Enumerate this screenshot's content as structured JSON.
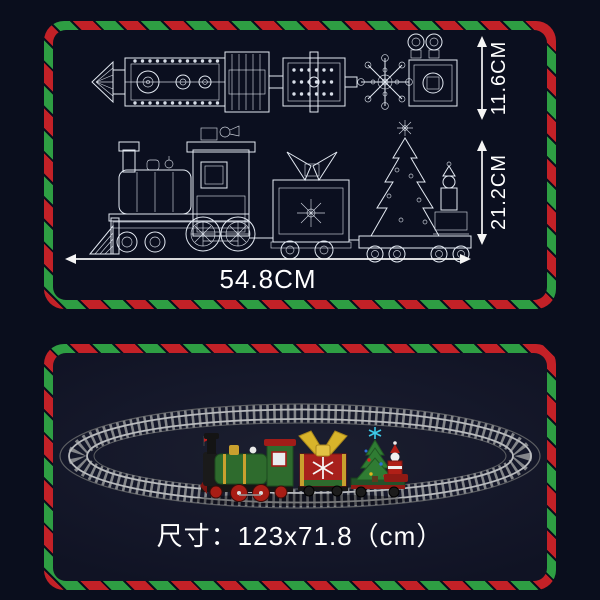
{
  "page": {
    "description": "Christmas brick train set dimension sheet",
    "background": "#0a0e1d"
  },
  "theme": {
    "border_red": "#c32127",
    "border_green": "#2e9e43",
    "blueprint_line": "#e3e9f2",
    "text_color": "#ffffff",
    "track_gray": "#84868a",
    "loco_green": "#2e6b2d",
    "wagon_red": "#a8201c",
    "bow_gold": "#d8b42a",
    "star_cyan": "#3cc8e8"
  },
  "top_panel": {
    "name": "train blueprint with dimensions",
    "labels": {
      "top_view_height": "11.6CM",
      "side_view_height": "21.2CM",
      "train_length": "54.8CM"
    }
  },
  "bottom_panel": {
    "name": "train on oval track",
    "caption": "尺寸：123x71.8（cm）"
  }
}
